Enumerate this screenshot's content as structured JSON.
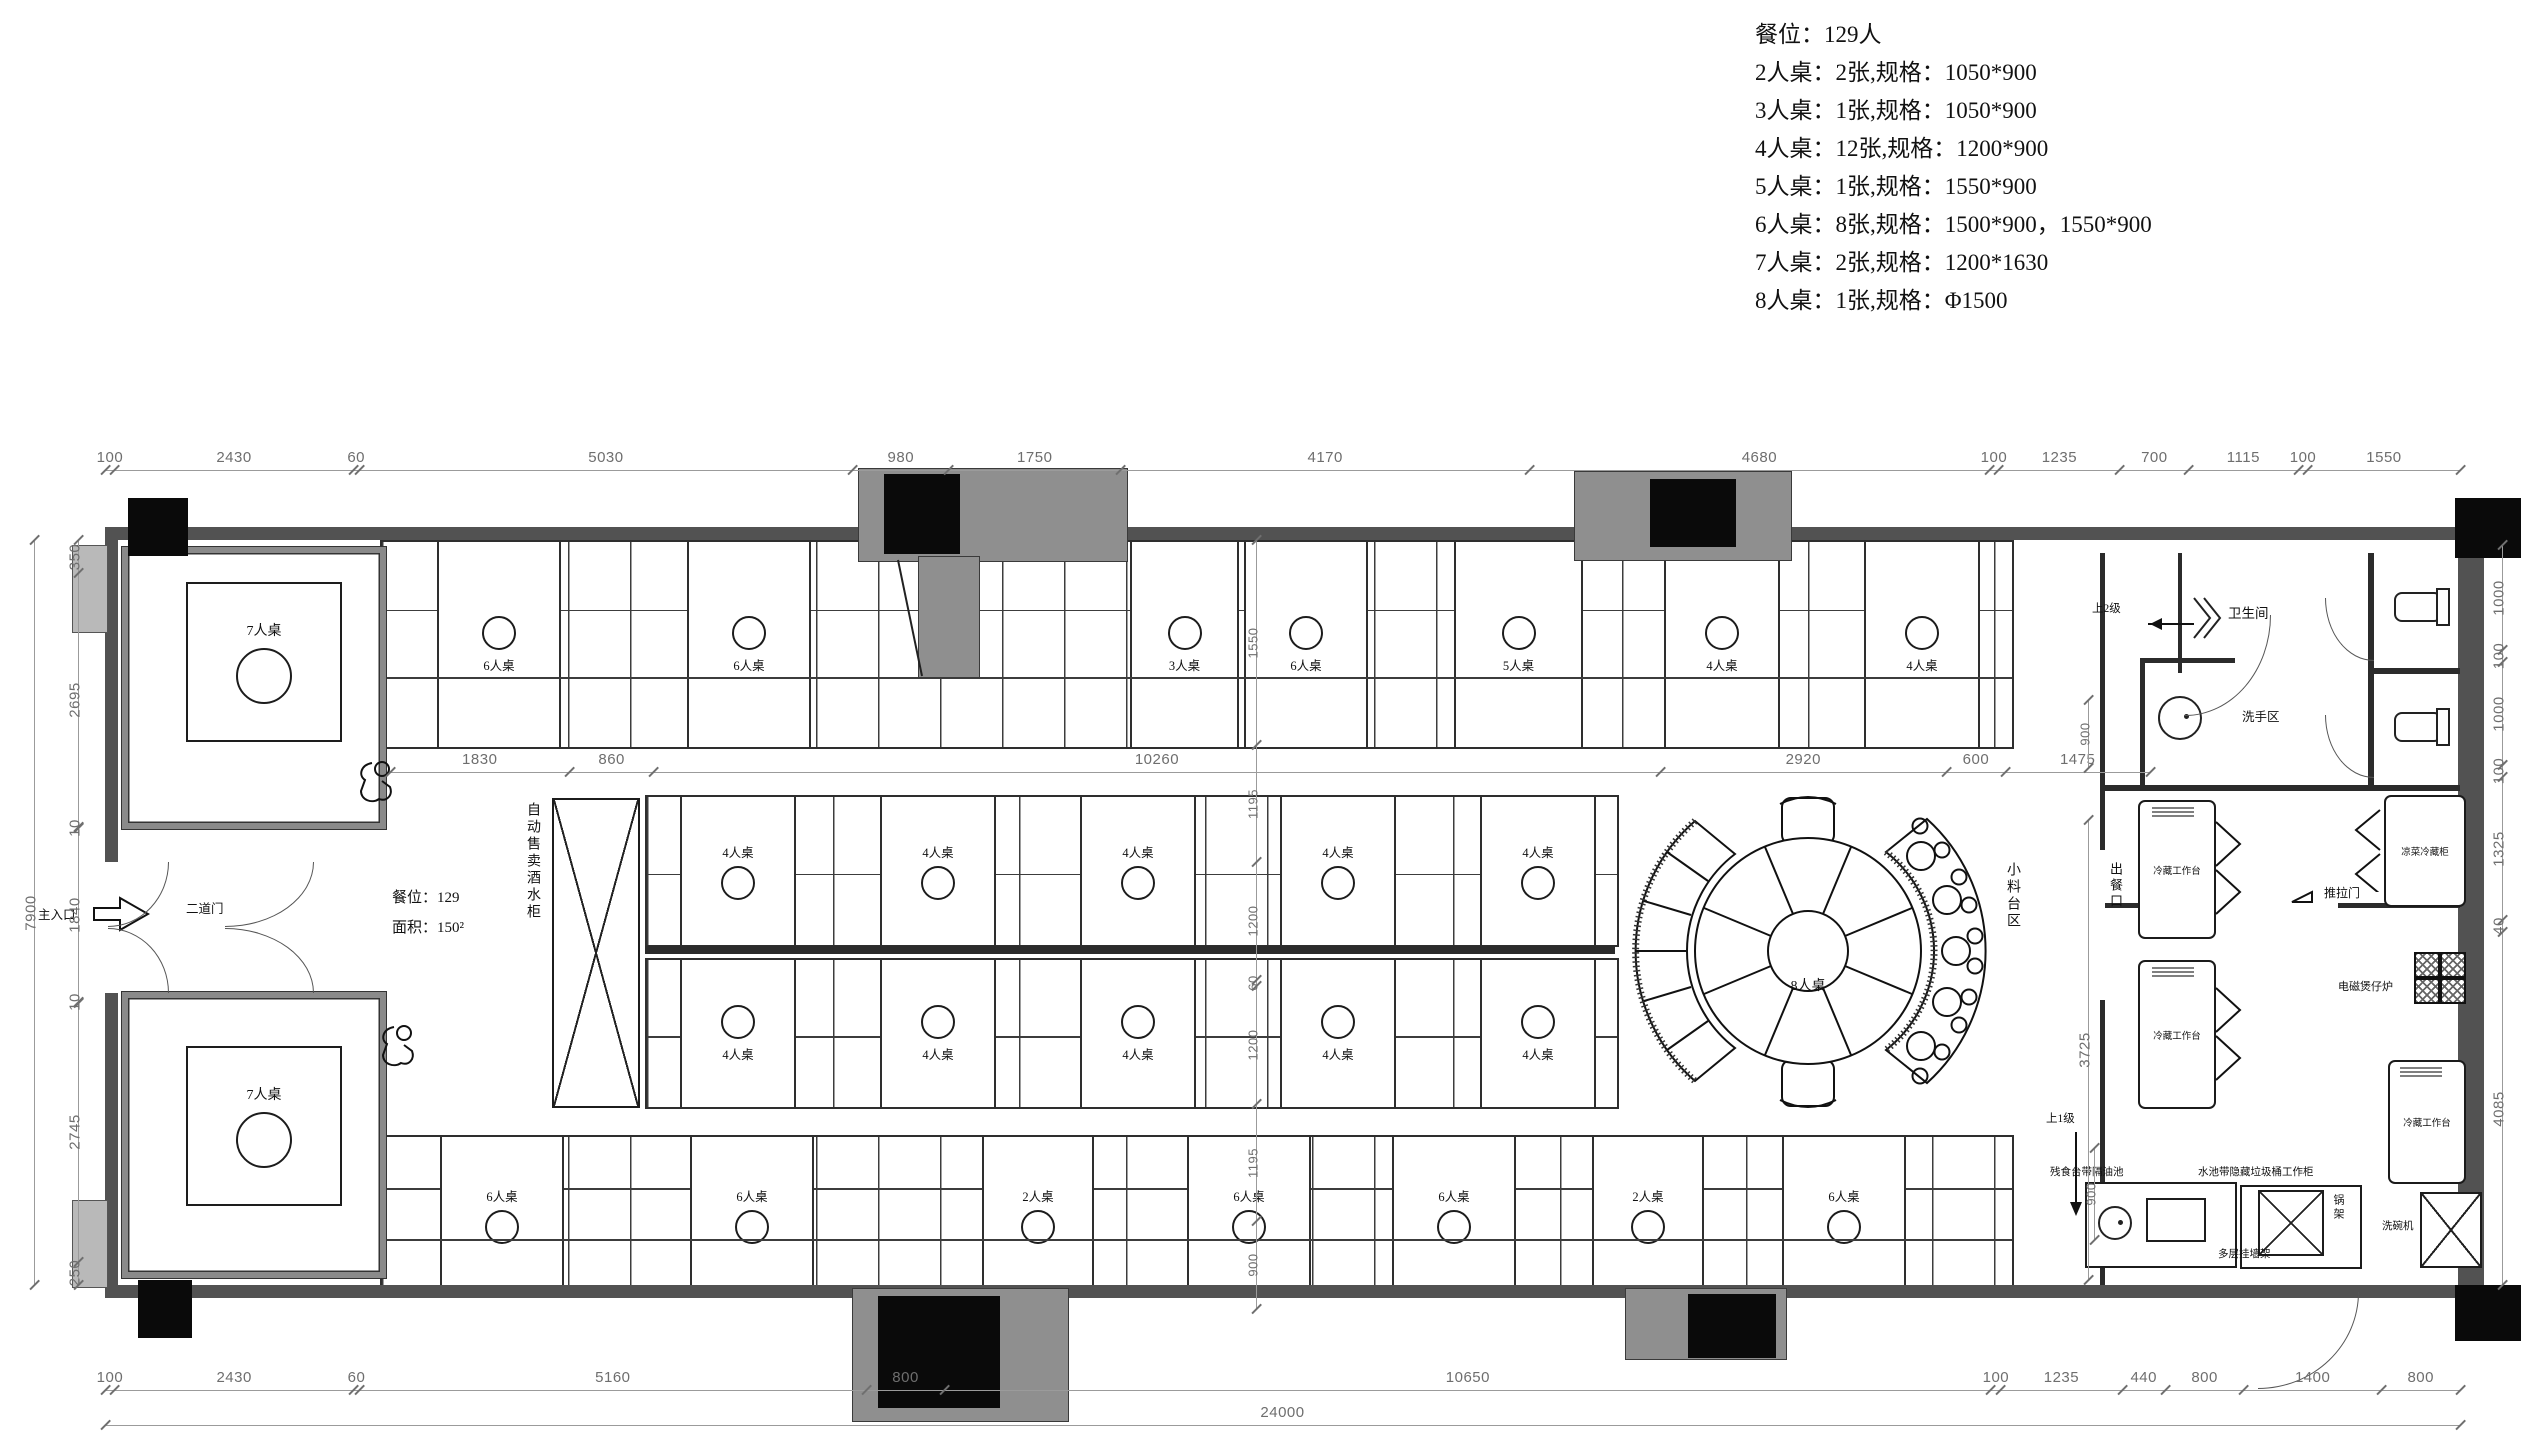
{
  "legend": {
    "title": "餐位：129人",
    "rows": [
      "2人桌：2张,规格：1050*900",
      "3人桌：1张,规格：1050*900",
      "4人桌：12张,规格：1200*900",
      "5人桌：1张,规格：1550*900",
      "6人桌：8张,规格：1500*900，1550*900",
      "7人桌：2张,规格：1200*1630",
      "8人桌：1张,规格：Φ1500"
    ]
  },
  "stats": {
    "seats": "餐位：129",
    "area": "面积：150²"
  },
  "entrance": {
    "main": "主入口",
    "second": "二道门"
  },
  "areas": {
    "toilet": "卫生间",
    "wash": "洗手区",
    "condiment": "小料台区",
    "vending": "自动售卖酒水柜",
    "serving": "出餐口",
    "up2": "上2级",
    "up1": "上1级"
  },
  "kitchen": {
    "cold_table1": "冷藏工作台",
    "cold_table2": "冷藏工作台",
    "cold_table3": "冷藏工作台",
    "cold_cabinet": "凉菜冷藏柜",
    "stove": "电磁煲仔炉",
    "sliding_door": "推拉门",
    "waste": "残食台带隔油池",
    "sink_cabinet": "水池带隐藏垃圾桶工作柜",
    "wall_rack": "多层挂墙架",
    "pot_rack": "锅架",
    "dishwasher": "洗碗机"
  },
  "tables": {
    "round": "8人桌",
    "left_rooms": [
      "7人桌",
      "7人桌"
    ],
    "top_row": [
      "6人桌",
      "6人桌",
      "3人桌",
      "6人桌",
      "5人桌",
      "4人桌",
      "4人桌"
    ],
    "mid_top_row": [
      "4人桌",
      "4人桌",
      "4人桌",
      "4人桌",
      "4人桌"
    ],
    "mid_bottom_row": [
      "4人桌",
      "4人桌",
      "4人桌",
      "4人桌",
      "4人桌"
    ],
    "bottom_row": [
      "6人桌",
      "6人桌",
      "2人桌",
      "6人桌",
      "6人桌",
      "2人桌",
      "6人桌"
    ]
  },
  "dims": {
    "top": [
      "100",
      "2430",
      "60",
      "5030",
      "980",
      "1750",
      "4170",
      "4680",
      "100",
      "1235",
      "700",
      "1115",
      "100",
      "1550"
    ],
    "bottom": [
      "100",
      "2430",
      "60",
      "5160",
      "800",
      "10650",
      "100",
      "1235",
      "440",
      "800",
      "1400",
      "800"
    ],
    "bottom_total": "24000",
    "left": [
      "350",
      "2695",
      "10",
      "1840",
      "10",
      "2745",
      "250"
    ],
    "left_total": "7900",
    "right": [
      "1000",
      "100",
      "1000",
      "100",
      "1325",
      "40",
      "4085"
    ],
    "interior": [
      "1830",
      "860",
      "10260",
      "2920",
      "600",
      "1475"
    ],
    "center_v": [
      "1550",
      "1195",
      "1200",
      "60",
      "1200",
      "1195",
      "900"
    ],
    "wash_v": "900",
    "kitchen_v": "3725",
    "corner_v": "900"
  }
}
